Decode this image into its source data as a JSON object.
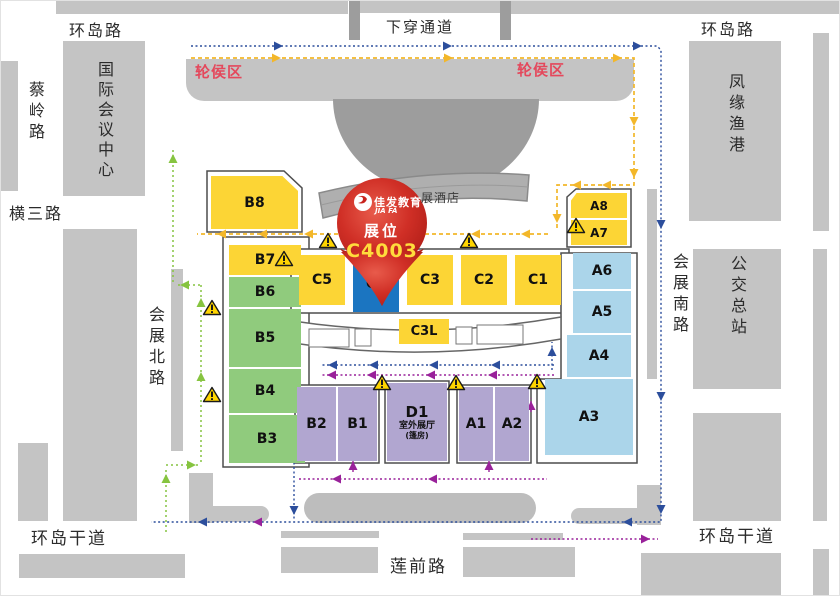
{
  "roads": {
    "ring_left": "环岛路",
    "underpass": "下穿通道",
    "ring_right": "环岛路",
    "cailing": "蔡岭路",
    "hengsan": "横三路",
    "north": "会展北路",
    "south": "会展南路",
    "ring_main_left": "环岛干道",
    "ring_main_right": "环岛干道",
    "lianqian": "莲前路"
  },
  "buildings": {
    "icc": "国际会议中心",
    "fishing_port": "凤缘渔港",
    "bus_terminal": "公交总站",
    "hotel_partial": "展酒店"
  },
  "areas": {
    "queue_left": "轮侯区",
    "queue_right": "轮侯区"
  },
  "pin": {
    "logo_cn": "佳发教育",
    "logo_en": "JIA FA",
    "label": "展位",
    "booth": "C4003"
  },
  "halls": {
    "B8": "B8",
    "B7": "B7",
    "B6": "B6",
    "B5": "B5",
    "B4": "B4",
    "B3": "B3",
    "B2": "B2",
    "B1": "B1",
    "C5": "C5",
    "C4": "C4",
    "C3": "C3",
    "C2": "C2",
    "C1": "C1",
    "C3L": "C3L",
    "A8": "A8",
    "A7": "A7",
    "A6": "A6",
    "A5": "A5",
    "A4": "A4",
    "A3": "A3",
    "A1": "A1",
    "A2": "A2",
    "D1": "D1"
  },
  "d1_annex": {
    "line1": "室外展厅",
    "line2": "(篷房)"
  },
  "colors": {
    "hall_yellow": "#FCD535",
    "hall_green": "#90CB7D",
    "hall_blue": "#ABD5EA",
    "hall_purple": "#B1A6D0",
    "highlight_blue": "#1B75C1",
    "pin_red": "#C8231D",
    "booth_text": "#FFDC3C",
    "queue_text_red": "#E4485C",
    "route_yellow": "#F3B72A",
    "route_blue": "#2C4E9C",
    "route_green": "#86C440",
    "route_purple": "#99219A",
    "block_gray": "#C4C4C4"
  }
}
